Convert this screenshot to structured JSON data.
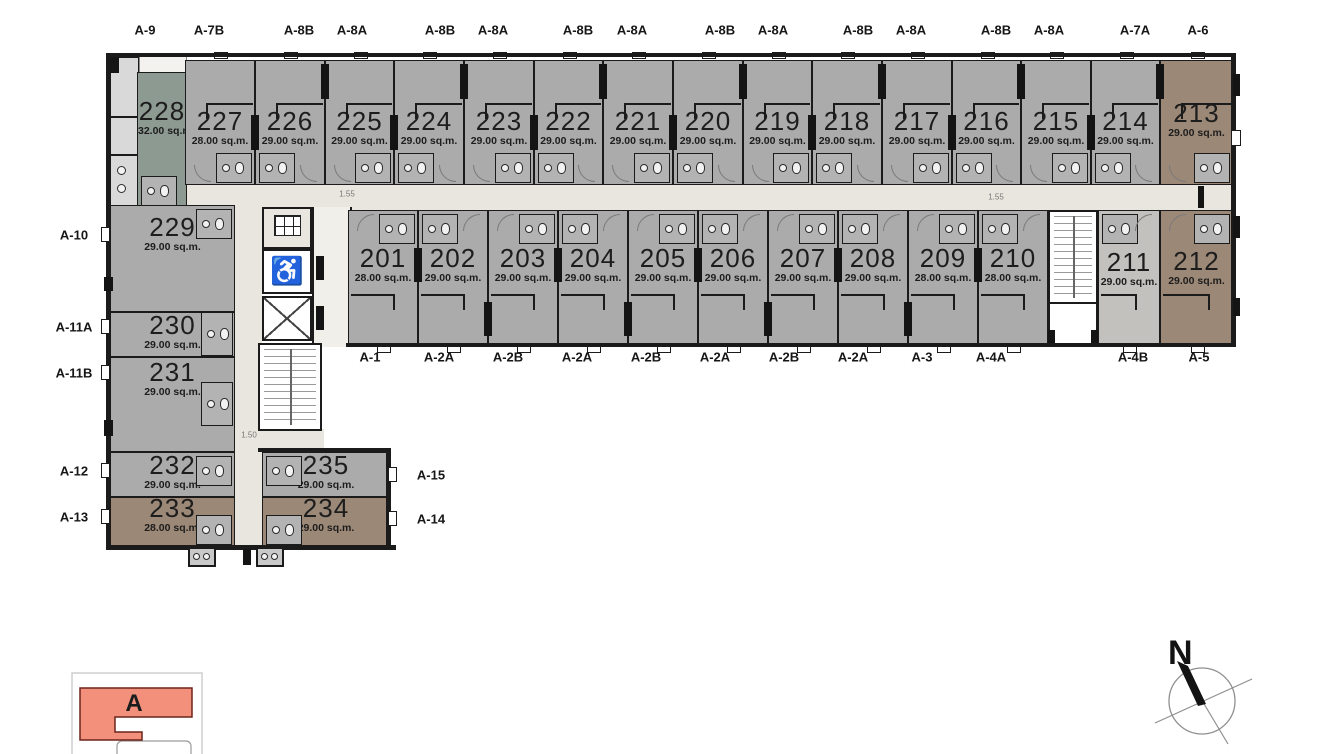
{
  "palette": {
    "wall": "#1b1b1b",
    "gray": "#ababab",
    "grayLight": "#c2c1bd",
    "sage": "#8d9a92",
    "brown": "#9c8876",
    "corridor": "#e9e6df",
    "lobby": "#f1efe9",
    "key_fill": "#f2907c",
    "key_stroke": "#6b241a"
  },
  "plan": {
    "building": "A",
    "units": [
      {
        "no": "228",
        "area": "32.00 sq.m.",
        "x": 137,
        "y": 72,
        "w": 50,
        "h": 136,
        "row": "none",
        "fill": "sage",
        "ly": 0.3,
        "bath": "bl"
      },
      {
        "no": "227",
        "area": "28.00 sq.m.",
        "x": 185,
        "y": 60,
        "w": 70,
        "h": 125,
        "row": "top",
        "fill": "gray",
        "ly": 0.5,
        "bath": "br"
      },
      {
        "no": "226",
        "area": "29.00 sq.m.",
        "x": 255,
        "y": 60,
        "w": 70,
        "h": 125,
        "row": "top",
        "fill": "gray",
        "ly": 0.5,
        "bath": "bl"
      },
      {
        "no": "225",
        "area": "29.00 sq.m.",
        "x": 325,
        "y": 60,
        "w": 69,
        "h": 125,
        "row": "top",
        "fill": "gray",
        "ly": 0.5,
        "bath": "br"
      },
      {
        "no": "224",
        "area": "29.00 sq.m.",
        "x": 394,
        "y": 60,
        "w": 70,
        "h": 125,
        "row": "top",
        "fill": "gray",
        "ly": 0.5,
        "bath": "bl"
      },
      {
        "no": "223",
        "area": "29.00 sq.m.",
        "x": 464,
        "y": 60,
        "w": 70,
        "h": 125,
        "row": "top",
        "fill": "gray",
        "ly": 0.5,
        "bath": "br"
      },
      {
        "no": "222",
        "area": "29.00 sq.m.",
        "x": 534,
        "y": 60,
        "w": 69,
        "h": 125,
        "row": "top",
        "fill": "gray",
        "ly": 0.5,
        "bath": "bl"
      },
      {
        "no": "221",
        "area": "29.00 sq.m.",
        "x": 603,
        "y": 60,
        "w": 70,
        "h": 125,
        "row": "top",
        "fill": "gray",
        "ly": 0.5,
        "bath": "br"
      },
      {
        "no": "220",
        "area": "29.00 sq.m.",
        "x": 673,
        "y": 60,
        "w": 70,
        "h": 125,
        "row": "top",
        "fill": "gray",
        "ly": 0.5,
        "bath": "bl"
      },
      {
        "no": "219",
        "area": "29.00 sq.m.",
        "x": 743,
        "y": 60,
        "w": 69,
        "h": 125,
        "row": "top",
        "fill": "gray",
        "ly": 0.5,
        "bath": "br"
      },
      {
        "no": "218",
        "area": "29.00 sq.m.",
        "x": 812,
        "y": 60,
        "w": 70,
        "h": 125,
        "row": "top",
        "fill": "gray",
        "ly": 0.5,
        "bath": "bl"
      },
      {
        "no": "217",
        "area": "29.00 sq.m.",
        "x": 882,
        "y": 60,
        "w": 70,
        "h": 125,
        "row": "top",
        "fill": "gray",
        "ly": 0.5,
        "bath": "br"
      },
      {
        "no": "216",
        "area": "29.00 sq.m.",
        "x": 952,
        "y": 60,
        "w": 69,
        "h": 125,
        "row": "top",
        "fill": "gray",
        "ly": 0.5,
        "bath": "bl"
      },
      {
        "no": "215",
        "area": "29.00 sq.m.",
        "x": 1021,
        "y": 60,
        "w": 70,
        "h": 125,
        "row": "top",
        "fill": "gray",
        "ly": 0.5,
        "bath": "br"
      },
      {
        "no": "214",
        "area": "29.00 sq.m.",
        "x": 1091,
        "y": 60,
        "w": 69,
        "h": 125,
        "row": "top",
        "fill": "gray",
        "ly": 0.5,
        "bath": "bl"
      },
      {
        "no": "213",
        "area": "29.00 sq.m.",
        "x": 1160,
        "y": 60,
        "w": 73,
        "h": 125,
        "row": "top",
        "fill": "brown",
        "ly": 0.44,
        "bath": "br"
      },
      {
        "no": "201",
        "area": "28.00 sq.m.",
        "x": 348,
        "y": 210,
        "w": 70,
        "h": 135,
        "row": "mid",
        "fill": "gray",
        "ly": 0.37,
        "bath": "tr"
      },
      {
        "no": "202",
        "area": "29.00 sq.m.",
        "x": 418,
        "y": 210,
        "w": 70,
        "h": 135,
        "row": "mid",
        "fill": "gray",
        "ly": 0.37,
        "bath": "tl"
      },
      {
        "no": "203",
        "area": "29.00 sq.m.",
        "x": 488,
        "y": 210,
        "w": 70,
        "h": 135,
        "row": "mid",
        "fill": "gray",
        "ly": 0.37,
        "bath": "tr"
      },
      {
        "no": "204",
        "area": "29.00 sq.m.",
        "x": 558,
        "y": 210,
        "w": 70,
        "h": 135,
        "row": "mid",
        "fill": "gray",
        "ly": 0.37,
        "bath": "tl"
      },
      {
        "no": "205",
        "area": "29.00 sq.m.",
        "x": 628,
        "y": 210,
        "w": 70,
        "h": 135,
        "row": "mid",
        "fill": "gray",
        "ly": 0.37,
        "bath": "tr"
      },
      {
        "no": "206",
        "area": "29.00 sq.m.",
        "x": 698,
        "y": 210,
        "w": 70,
        "h": 135,
        "row": "mid",
        "fill": "gray",
        "ly": 0.37,
        "bath": "tl"
      },
      {
        "no": "207",
        "area": "29.00 sq.m.",
        "x": 768,
        "y": 210,
        "w": 70,
        "h": 135,
        "row": "mid",
        "fill": "gray",
        "ly": 0.37,
        "bath": "tr"
      },
      {
        "no": "208",
        "area": "29.00 sq.m.",
        "x": 838,
        "y": 210,
        "w": 70,
        "h": 135,
        "row": "mid",
        "fill": "gray",
        "ly": 0.37,
        "bath": "tl"
      },
      {
        "no": "209",
        "area": "28.00 sq.m.",
        "x": 908,
        "y": 210,
        "w": 70,
        "h": 135,
        "row": "mid",
        "fill": "gray",
        "ly": 0.37,
        "bath": "tr"
      },
      {
        "no": "210",
        "area": "28.00 sq.m.",
        "x": 978,
        "y": 210,
        "w": 70,
        "h": 135,
        "row": "mid",
        "fill": "gray",
        "ly": 0.37,
        "bath": "tl"
      },
      {
        "no": "211",
        "area": "29.00 sq.m.",
        "x": 1098,
        "y": 210,
        "w": 62,
        "h": 135,
        "row": "mid",
        "fill": "grayLight",
        "ly": 0.4,
        "bath": "tl"
      },
      {
        "no": "212",
        "area": "29.00 sq.m.",
        "x": 1160,
        "y": 210,
        "w": 73,
        "h": 135,
        "row": "mid",
        "fill": "brown",
        "ly": 0.39,
        "bath": "tr"
      },
      {
        "no": "229",
        "area": "29.00 sq.m.",
        "x": 110,
        "y": 205,
        "w": 125,
        "h": 107,
        "row": "none",
        "fill": "gray",
        "ly": 0.22,
        "bath": "tr"
      },
      {
        "no": "230",
        "area": "29.00 sq.m.",
        "x": 110,
        "y": 312,
        "w": 125,
        "h": 45,
        "row": "none",
        "fill": "gray",
        "ly": 0.33,
        "bath": "r"
      },
      {
        "no": "231",
        "area": "29.00 sq.m.",
        "x": 110,
        "y": 357,
        "w": 125,
        "h": 95,
        "row": "none",
        "fill": "gray",
        "ly": 0.18,
        "bath": "r"
      },
      {
        "no": "232",
        "area": "29.00 sq.m.",
        "x": 110,
        "y": 452,
        "w": 125,
        "h": 45,
        "row": "none",
        "fill": "gray",
        "ly": 0.33,
        "bath": "tr"
      },
      {
        "no": "233",
        "area": "28.00 sq.m.",
        "x": 110,
        "y": 497,
        "w": 125,
        "h": 50,
        "row": "none",
        "fill": "brown",
        "ly": 0.26,
        "bath": "br"
      },
      {
        "no": "235",
        "area": "29.00 sq.m.",
        "x": 262,
        "y": 452,
        "w": 128,
        "h": 45,
        "row": "none",
        "fill": "gray",
        "ly": 0.33,
        "bath": "tl"
      },
      {
        "no": "234",
        "area": "29.00 sq.m.",
        "x": 262,
        "y": 497,
        "w": 128,
        "h": 50,
        "row": "none",
        "fill": "brown",
        "ly": 0.26,
        "bath": "bl"
      }
    ],
    "type_labels": {
      "top": [
        {
          "text": "A-9",
          "x": 145
        },
        {
          "text": "A-7B",
          "x": 209
        },
        {
          "text": "A-8B",
          "x": 299
        },
        {
          "text": "A-8A",
          "x": 352
        },
        {
          "text": "A-8B",
          "x": 440
        },
        {
          "text": "A-8A",
          "x": 493
        },
        {
          "text": "A-8B",
          "x": 578
        },
        {
          "text": "A-8A",
          "x": 632
        },
        {
          "text": "A-8B",
          "x": 720
        },
        {
          "text": "A-8A",
          "x": 773
        },
        {
          "text": "A-8B",
          "x": 858
        },
        {
          "text": "A-8A",
          "x": 911
        },
        {
          "text": "A-8B",
          "x": 996
        },
        {
          "text": "A-8A",
          "x": 1049
        },
        {
          "text": "A-7A",
          "x": 1135
        },
        {
          "text": "A-6",
          "x": 1198
        }
      ],
      "bottom": [
        {
          "text": "A-1",
          "x": 370
        },
        {
          "text": "A-2A",
          "x": 439
        },
        {
          "text": "A-2B",
          "x": 508
        },
        {
          "text": "A-2A",
          "x": 577
        },
        {
          "text": "A-2B",
          "x": 646
        },
        {
          "text": "A-2A",
          "x": 715
        },
        {
          "text": "A-2B",
          "x": 784
        },
        {
          "text": "A-2A",
          "x": 853
        },
        {
          "text": "A-3",
          "x": 922
        },
        {
          "text": "A-4A",
          "x": 991
        },
        {
          "text": "A-4B",
          "x": 1133
        },
        {
          "text": "A-5",
          "x": 1199
        }
      ],
      "left": [
        {
          "text": "A-10",
          "y": 235
        },
        {
          "text": "A-11A",
          "y": 327
        },
        {
          "text": "A-11B",
          "y": 373
        },
        {
          "text": "A-12",
          "y": 471
        },
        {
          "text": "A-13",
          "y": 517
        }
      ],
      "right": [
        {
          "text": "A-15",
          "y": 475
        },
        {
          "text": "A-14",
          "y": 519
        }
      ]
    },
    "dimensions": [
      {
        "text": "1.55",
        "x": 347,
        "y": 194
      },
      {
        "text": "1.55",
        "x": 996,
        "y": 197
      },
      {
        "text": "1.50",
        "x": 249,
        "y": 435
      }
    ],
    "compass": {
      "north_label": "N"
    },
    "legend": {
      "building_label": "A"
    }
  }
}
